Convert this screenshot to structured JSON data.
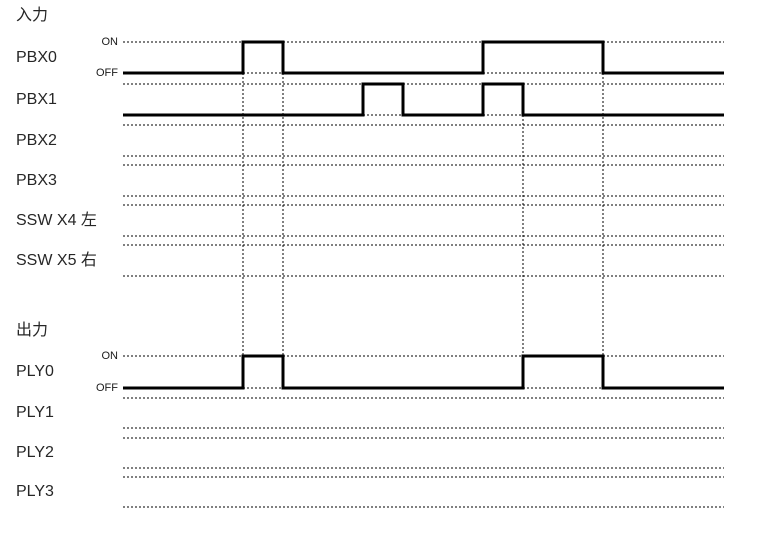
{
  "colors": {
    "background": "#ffffff",
    "line": "#000000",
    "text": "#262626"
  },
  "diagram": {
    "width": 758,
    "height": 534,
    "x_start": 123,
    "x_end": 724,
    "level_labels": {
      "on": "ON",
      "off": "OFF"
    },
    "sections": [
      {
        "id": "input",
        "title": "入力"
      },
      {
        "id": "output",
        "title": "出力"
      }
    ],
    "channels": [
      {
        "label": "PBX0",
        "section": "input",
        "on_y": 42,
        "off_y": 73,
        "show_level_labels": true,
        "pulses": [
          [
            243,
            283
          ],
          [
            483,
            603
          ]
        ]
      },
      {
        "label": "PBX1",
        "section": "input",
        "on_y": 84,
        "off_y": 115,
        "show_level_labels": false,
        "pulses": [
          [
            363,
            403
          ],
          [
            483,
            523
          ]
        ]
      },
      {
        "label": "PBX2",
        "section": "input",
        "on_y": 125,
        "off_y": 156,
        "show_level_labels": false,
        "pulses": null
      },
      {
        "label": "PBX3",
        "section": "input",
        "on_y": 165,
        "off_y": 196,
        "show_level_labels": false,
        "pulses": null
      },
      {
        "label": "SSW X4 左",
        "section": "input",
        "on_y": 205,
        "off_y": 236,
        "show_level_labels": false,
        "pulses": null
      },
      {
        "label": "SSW X5 右",
        "section": "input",
        "on_y": 245,
        "off_y": 276,
        "show_level_labels": false,
        "pulses": null
      },
      {
        "label": "PLY0",
        "section": "output",
        "on_y": 356,
        "off_y": 388,
        "show_level_labels": true,
        "pulses": [
          [
            243,
            283
          ],
          [
            523,
            603
          ]
        ]
      },
      {
        "label": "PLY1",
        "section": "output",
        "on_y": 398,
        "off_y": 428,
        "show_level_labels": false,
        "pulses": null
      },
      {
        "label": "PLY2",
        "section": "output",
        "on_y": 438,
        "off_y": 468,
        "show_level_labels": false,
        "pulses": null
      },
      {
        "label": "PLY3",
        "section": "output",
        "on_y": 477,
        "off_y": 507,
        "show_level_labels": false,
        "pulses": null
      }
    ],
    "event_gridlines": [
      {
        "x": 243,
        "y1": 73,
        "y2": 356
      },
      {
        "x": 283,
        "y1": 73,
        "y2": 356
      },
      {
        "x": 523,
        "y1": 115,
        "y2": 356
      },
      {
        "x": 603,
        "y1": 73,
        "y2": 356
      }
    ]
  }
}
